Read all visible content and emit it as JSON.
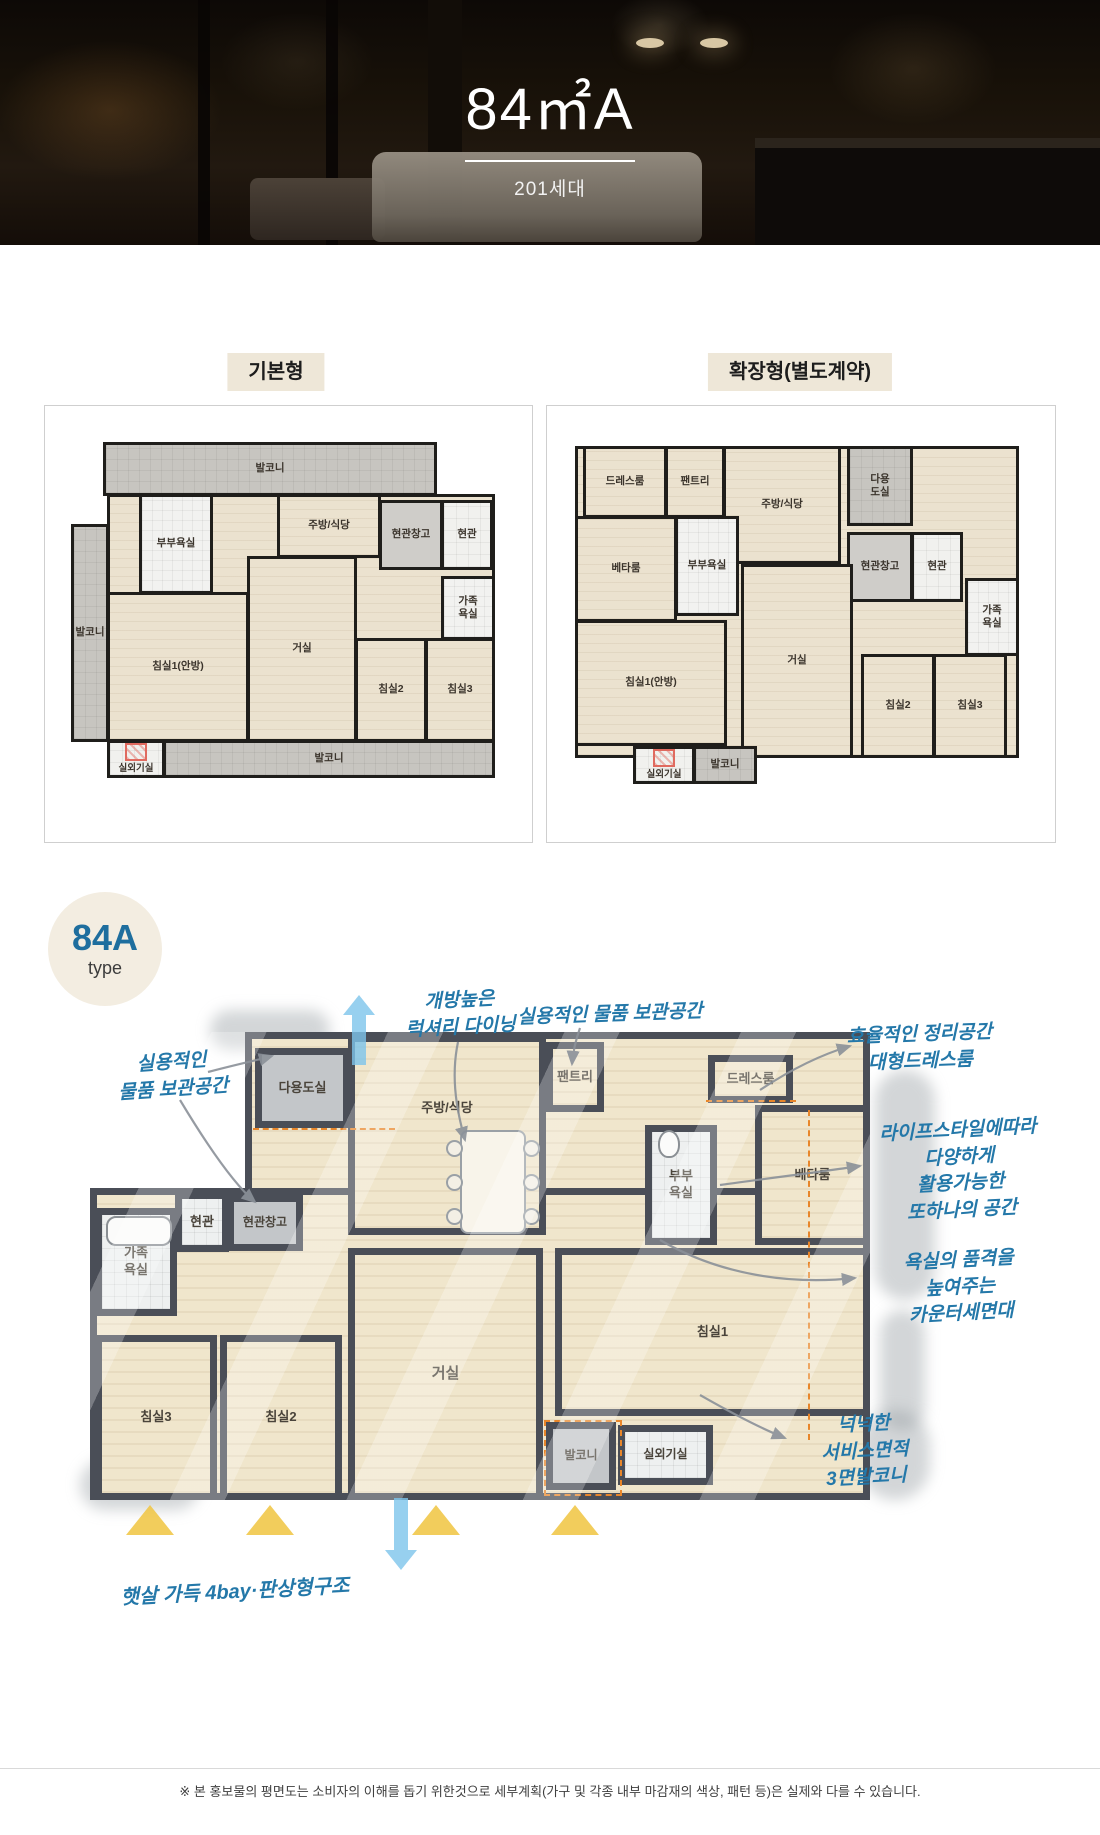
{
  "hero": {
    "title": "84㎡A",
    "units": "201세대"
  },
  "section": {
    "basic_label": "기본형",
    "extended_label": "확장형(별도계약)"
  },
  "plan_basic": {
    "rooms": {
      "balcony_top": "발코니",
      "balcony_left": "발코니",
      "master_bath": "부부욕실",
      "kitchen": "주방/식당",
      "entry_storage": "현관창고",
      "entry": "현관",
      "family_bath": "가족\n욕실",
      "bedroom1": "침실1(안방)",
      "living": "거실",
      "bedroom2": "침실2",
      "bedroom3": "침실3",
      "ac_room": "실외기실",
      "balcony_bottom": "발코니"
    }
  },
  "plan_extended": {
    "rooms": {
      "dress_room": "드레스룸",
      "pantry": "팬트리",
      "kitchen": "주방/식당",
      "utility": "다용\n도실",
      "beta_room": "베타룸",
      "master_bath": "부부욕실",
      "entry_storage": "현관창고",
      "entry": "현관",
      "family_bath": "가족\n욕실",
      "bedroom1": "침실1(안방)",
      "living": "거실",
      "bedroom2": "침실2",
      "bedroom3": "침실3",
      "ac_room": "실외기실",
      "balcony": "발코니"
    }
  },
  "badge": {
    "title": "84A",
    "subtitle": "type"
  },
  "sketch": {
    "rooms": {
      "utility": "다용도실",
      "kitchen": "주방/식당",
      "pantry": "팬트리",
      "dress_room": "드레스룸",
      "master_bath": "부부\n욕실",
      "beta_room": "베타룸",
      "entry": "현관",
      "entry_storage": "현관창고",
      "family_bath": "가족\n욕실",
      "bedroom3": "침실3",
      "bedroom2": "침실2",
      "living": "거실",
      "bedroom1": "침실1",
      "balcony": "발코니",
      "ac_room": "실외기실"
    },
    "annotations": {
      "storage_left": "실용적인\n물품 보관공간",
      "dining": "개방높은\n럭셔리 다이닝",
      "storage_top": "실용적인 물품 보관공간",
      "dress_room": "효율적인 정리공간\n대형드레스룸",
      "beta_room": "라이프스타일에따라\n다양하게\n활용가능한\n또하나의 공간",
      "counter": "욕실의 품격을\n높여주는\n카운터세면대",
      "balcony": "넉넉한\n서비스면적\n3면발코니",
      "bay": "햇살 가득 4bay·판상형구조"
    }
  },
  "footer": {
    "disclaimer": "※ 본 홍보물의 평면도는 소비자의 이해를 돕기 위한것으로 세부계획(가구 및 각종 내부 마감재의 색상, 패턴 등)은 실제와 다를 수 있습니다."
  },
  "colors": {
    "annotation_blue": "#2478a9",
    "badge_blue": "#1e6e9e",
    "dash_orange": "#e8862a",
    "sun_yellow": "#f0c440",
    "flow_arrow_blue": "#7dc4eb",
    "label_bg": "#eee7d8"
  }
}
